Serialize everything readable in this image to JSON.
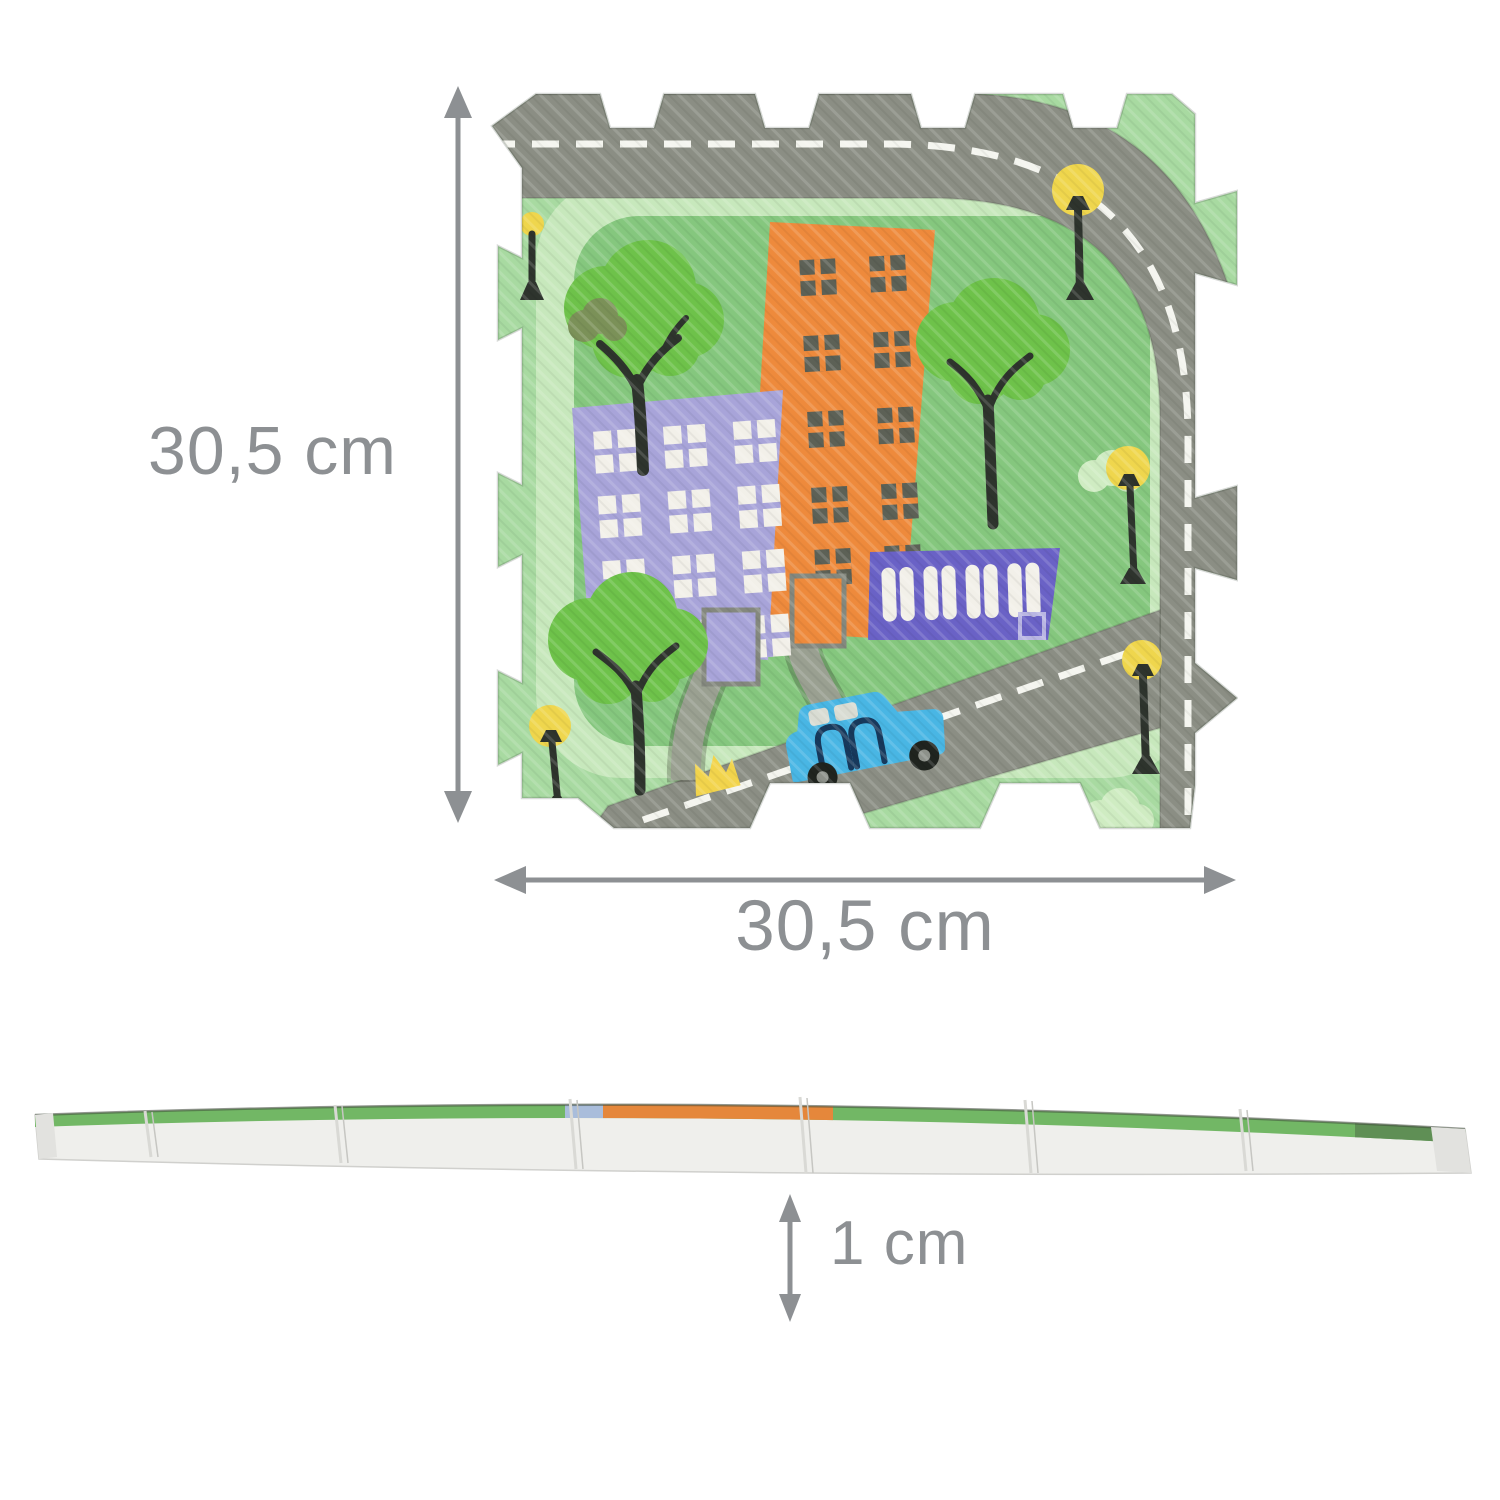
{
  "diagram": {
    "top_view": {
      "description": "puzzle play mat tile with city road print",
      "height_label": "30,5 cm",
      "width_label": "30,5 cm"
    },
    "side_view": {
      "description": "mat thickness side profile",
      "thickness_label": "1 cm"
    }
  },
  "colors": {
    "dimension_grey": "#8d9093",
    "mat_border_green": "#a8daa1",
    "mat_ring_green": "#c7e8bc",
    "mat_center_green": "#85c77e",
    "road_grey": "#8b8e84",
    "path_grey": "#9aa091",
    "road_line_white": "#f4f5ef",
    "building_lavender": "#a8a4d9",
    "building_orange": "#ee8a3c",
    "building_indigo": "#6a62c6",
    "window_white": "#f2f0e9",
    "window_dark": "#5d6156",
    "door_outline_grey": "#84887e",
    "tree_green": "#6ec24a",
    "tree_light_green": "#cfecc2",
    "bush_olive": "#7b9158",
    "trunk_dark": "#2e342d",
    "lamp_yellow": "#efd64d",
    "car_blue": "#49b6e4",
    "car_outline_navy": "#17395c",
    "car_window_grey": "#d9dcd3",
    "wheel_black": "#20241f",
    "wheel_hub_grey": "#8d918a",
    "flower_yellow": "#f2d44c",
    "foam_white": "#efefec"
  }
}
